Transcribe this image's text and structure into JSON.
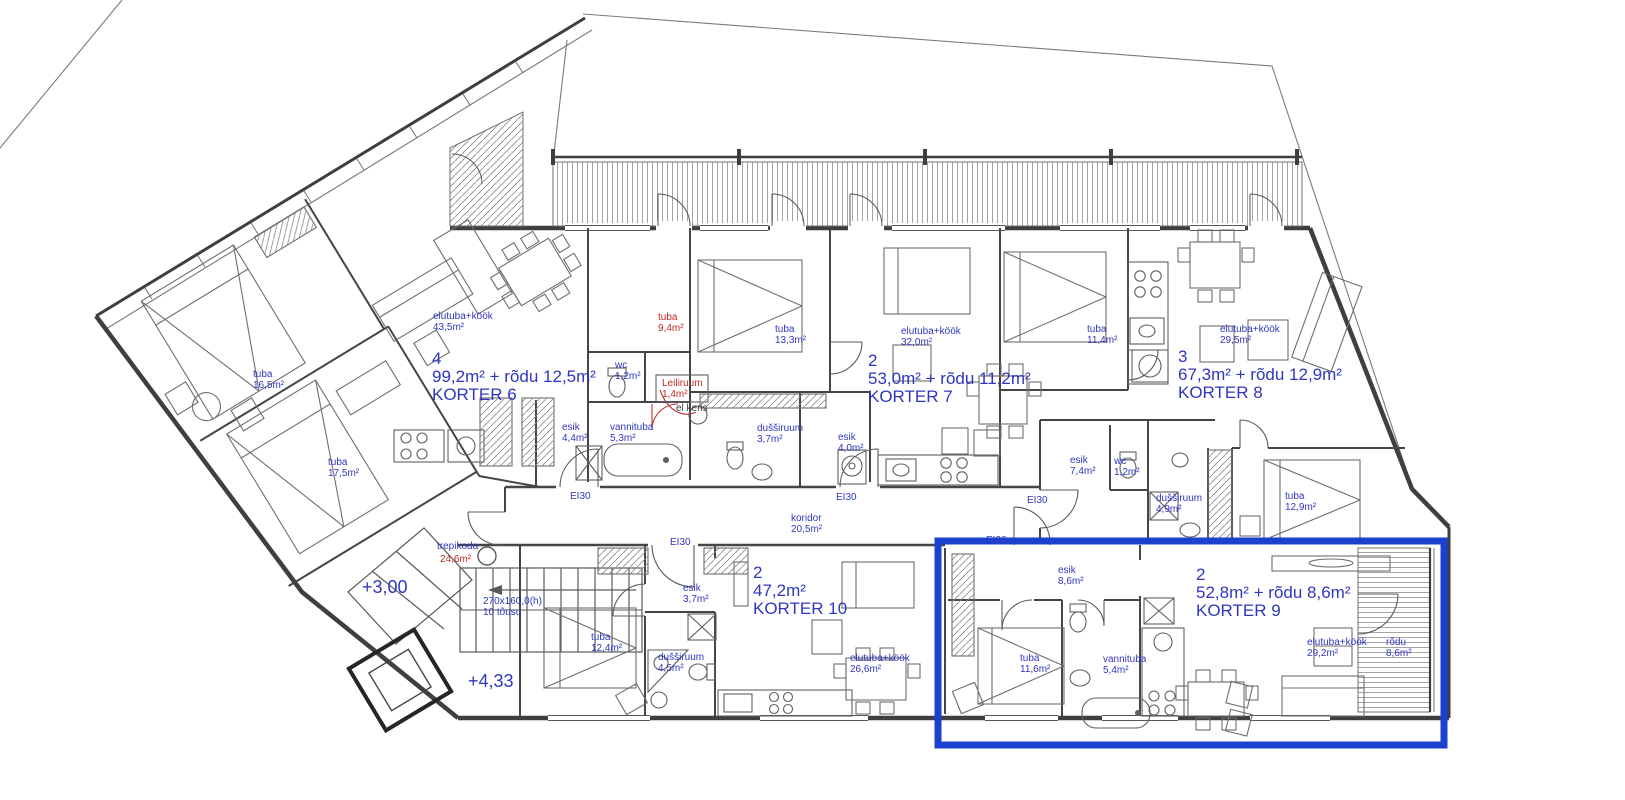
{
  "plan": {
    "colors": {
      "text_blue": "#2f36bf",
      "text_red": "#c22a22",
      "text_dark": "#3c3c3c",
      "highlight_blue": "#1b41cf",
      "wall_gray": "#3f3f3f"
    },
    "apartments": [
      {
        "rooms": "4",
        "area": "99,2m² + rõdu 12,5m²",
        "name": "KORTER 6",
        "x": 432,
        "y": 350,
        "highlighted": false
      },
      {
        "rooms": "2",
        "area": "53,0m² + rõdu 11,2m²",
        "name": "KORTER 7",
        "x": 868,
        "y": 352,
        "highlighted": false
      },
      {
        "rooms": "3",
        "area": "67,3m² + rõdu 12,9m²",
        "name": "KORTER 8",
        "x": 1178,
        "y": 348,
        "highlighted": false
      },
      {
        "rooms": "2",
        "area": "52,8m² + rõdu 8,6m²",
        "name": "KORTER 9",
        "x": 1196,
        "y": 566,
        "highlighted": true
      },
      {
        "rooms": "2",
        "area": "47,2m²",
        "name": "KORTER 10",
        "x": 753,
        "y": 564,
        "highlighted": false
      }
    ],
    "room_labels": [
      {
        "lines": [
          "elutuba+köök",
          "43,5m²"
        ],
        "x": 433,
        "y": 311
      },
      {
        "lines": [
          "tuba",
          "16,5m²"
        ],
        "x": 253,
        "y": 369
      },
      {
        "lines": [
          "tuba",
          "17,5m²"
        ],
        "x": 328,
        "y": 457
      },
      {
        "lines": [
          "tuba",
          "9,4m²"
        ],
        "x": 658,
        "y": 312,
        "color": "red"
      },
      {
        "lines": [
          "wc",
          "1,2m²"
        ],
        "x": 615,
        "y": 360
      },
      {
        "lines": [
          "Leiliruum",
          "1,4m²"
        ],
        "x": 662,
        "y": 378,
        "color": "red"
      },
      {
        "lines": [
          "el keris"
        ],
        "x": 676,
        "y": 403,
        "color": "dark"
      },
      {
        "lines": [
          "esik",
          "4,4m²"
        ],
        "x": 562,
        "y": 422
      },
      {
        "lines": [
          "vannituba",
          "5,3m²"
        ],
        "x": 610,
        "y": 422
      },
      {
        "lines": [
          "tuba",
          "13,3m²"
        ],
        "x": 775,
        "y": 324
      },
      {
        "lines": [
          "dušširuum",
          "3,7m²"
        ],
        "x": 757,
        "y": 423
      },
      {
        "lines": [
          "esik",
          "4,0m²"
        ],
        "x": 838,
        "y": 432
      },
      {
        "lines": [
          "elutuba+köök",
          "32,0m²"
        ],
        "x": 901,
        "y": 326
      },
      {
        "lines": [
          "tuba",
          "11,4m²"
        ],
        "x": 1087,
        "y": 324
      },
      {
        "lines": [
          "elutuba+köök",
          "29,5m²"
        ],
        "x": 1220,
        "y": 324
      },
      {
        "lines": [
          "esik",
          "7,4m²"
        ],
        "x": 1070,
        "y": 455
      },
      {
        "lines": [
          "wc",
          "1,2m²"
        ],
        "x": 1114,
        "y": 456
      },
      {
        "lines": [
          "dušširuum",
          "4,9m²"
        ],
        "x": 1156,
        "y": 493
      },
      {
        "lines": [
          "tuba",
          "12,9m²"
        ],
        "x": 1285,
        "y": 491
      },
      {
        "lines": [
          "koridor",
          "20,5m²"
        ],
        "x": 791,
        "y": 513
      },
      {
        "lines": [
          "trepikoda"
        ],
        "x": 437,
        "y": 541
      },
      {
        "lines": [
          "24,6m²"
        ],
        "x": 440,
        "y": 554,
        "color": "red"
      },
      {
        "lines": [
          "esik",
          "3,7m²"
        ],
        "x": 683,
        "y": 583
      },
      {
        "lines": [
          "tuba",
          "12,4m²"
        ],
        "x": 591,
        "y": 632
      },
      {
        "lines": [
          "dušširuum",
          "4,5m²"
        ],
        "x": 658,
        "y": 652
      },
      {
        "lines": [
          "elutuba+köök",
          "26,6m²"
        ],
        "x": 850,
        "y": 653
      },
      {
        "lines": [
          "esik",
          "8,6m²"
        ],
        "x": 1058,
        "y": 565
      },
      {
        "lines": [
          "tuba",
          "11,6m²"
        ],
        "x": 1020,
        "y": 653
      },
      {
        "lines": [
          "vannituba",
          "5,4m²"
        ],
        "x": 1103,
        "y": 654
      },
      {
        "lines": [
          "elutuba+köök",
          "29,2m²"
        ],
        "x": 1307,
        "y": 637
      },
      {
        "lines": [
          "rõdu",
          "8,6m²"
        ],
        "x": 1386,
        "y": 637
      }
    ],
    "fire_ratings": [
      {
        "text": "EI30",
        "x": 570,
        "y": 491
      },
      {
        "text": "EI30",
        "x": 670,
        "y": 537
      },
      {
        "text": "EI30",
        "x": 836,
        "y": 492
      },
      {
        "text": "EI30",
        "x": 1027,
        "y": 495
      },
      {
        "text": "EI30",
        "x": 986,
        "y": 535
      }
    ],
    "elevations": [
      {
        "text": "+3,00",
        "x": 362,
        "y": 578
      },
      {
        "text": "+4,33",
        "x": 468,
        "y": 672
      }
    ],
    "stair_note": {
      "lines": [
        "270x160,0(h)",
        "10 tõusu"
      ],
      "x": 483,
      "y": 596
    }
  }
}
